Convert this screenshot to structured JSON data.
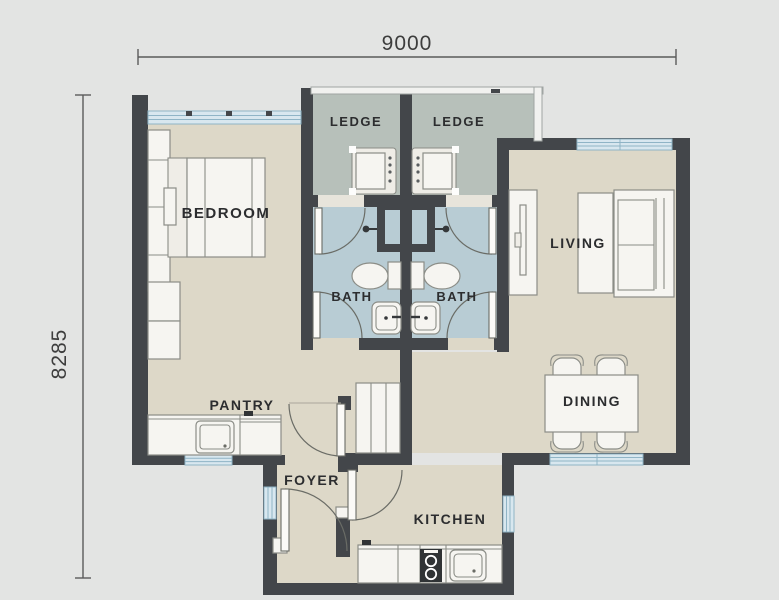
{
  "page": {
    "background": "#e3e4e3",
    "type": "apartment floor plan"
  },
  "colors": {
    "page": "#e3e4e3",
    "wall": "#43464a",
    "floor": "#ddd8c8",
    "ledge": "#b7c0ba",
    "bath": "#b8ccd4",
    "window": "#d8e7ef",
    "window_line": "#8fb4c6",
    "furniture_fill": "#f6f5f1",
    "furniture_line": "#8b8d87",
    "door_arc": "#6a6c66",
    "label_text": "#2c2d2f",
    "dimension_text": "#3d3d3d",
    "dimension_line": "#5b5b5b"
  },
  "dimensions": {
    "width": "9000",
    "height": "8285"
  },
  "rooms": {
    "bedroom": "BEDROOM",
    "ledge_left": "LEDGE",
    "ledge_right": "LEDGE",
    "living": "LIVING",
    "bath_left": "BATH",
    "bath_right": "BATH",
    "pantry": "PANTRY",
    "dining": "DINING",
    "foyer": "FOYER",
    "kitchen": "KITCHEN"
  }
}
